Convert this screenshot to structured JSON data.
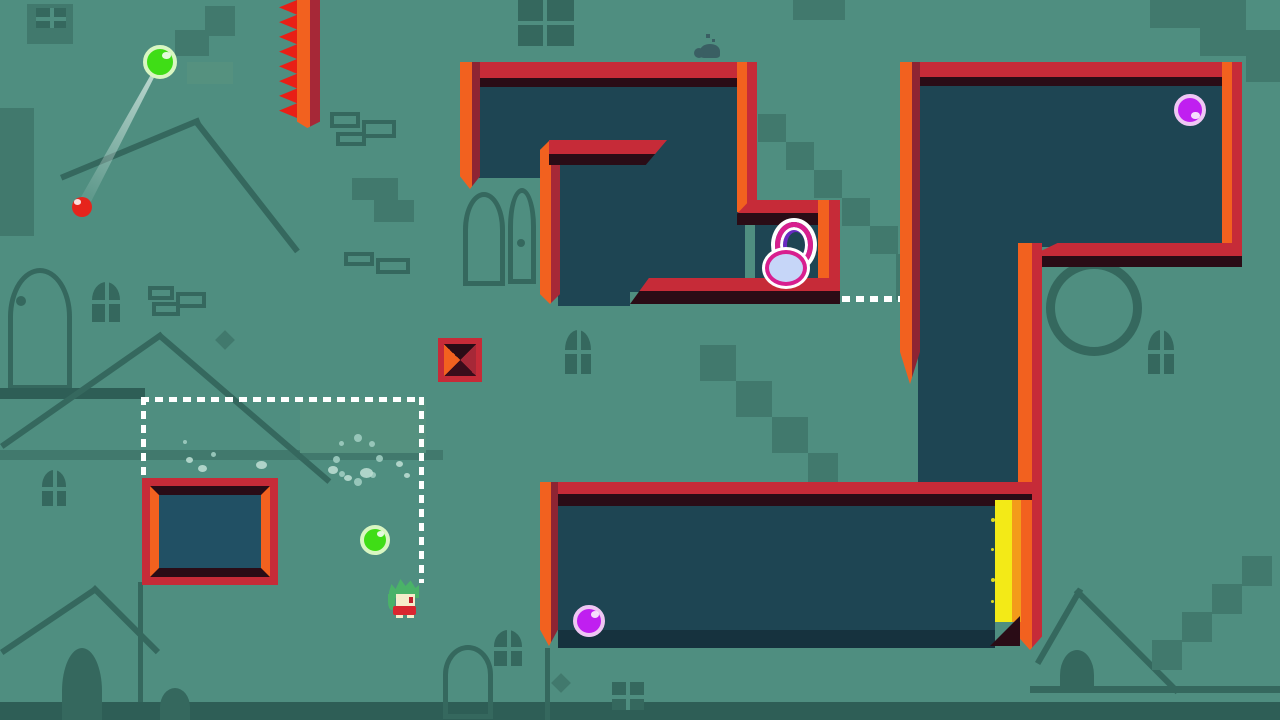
{
  "meta": {
    "view": "level-playfield",
    "width": 1280,
    "height": 720
  },
  "palette": {
    "bg": "#4f8e80",
    "shape_dark": "#41796d",
    "shape_light": "#55917f",
    "outline": "#35685e",
    "deep": "#2e5e56",
    "navy": "#1e4553",
    "navy_light": "#215064",
    "navy_floor": "#16323e",
    "crimson": "#c62b38",
    "wall_shadow": "#2a0c16",
    "orange": "#f2611f",
    "dark_red": "#8e2433",
    "inner_red": "#a62837",
    "spike_red": "#e81f16",
    "yellow": "#f3ea17",
    "yellow_orange": "#f39b1a",
    "white": "#ffffff",
    "green_fill": "#3fdd16",
    "green_rim": "#d9f6c2",
    "purple_fill": "#c01ff0",
    "purple_rim": "#efc7f4",
    "red_fill": "#e6241c",
    "ring_pink": "#d81f8f",
    "ring_purple": "#6a2ac2",
    "ring_fill": "#c6d6f8",
    "hair": "#4ab268",
    "skin": "#f6ecca",
    "outfit": "#d92630",
    "eye": "#bf1f2d",
    "critter": "#3a5f63",
    "dust": "#9fccc0",
    "dust_light": "#b9dbd0",
    "trail": "rgba(235,247,242,0.75)"
  },
  "background": {
    "shapes": [
      {
        "kind": "rect",
        "x": 27,
        "y": 4,
        "w": 46,
        "h": 40,
        "tone": "d"
      },
      {
        "kind": "win4",
        "x": 36,
        "y": 8,
        "w": 30,
        "h": 20
      },
      {
        "kind": "rect",
        "x": 205,
        "y": 6,
        "w": 30,
        "h": 30,
        "tone": "d"
      },
      {
        "kind": "rect",
        "x": 175,
        "y": 30,
        "w": 34,
        "h": 26,
        "tone": "d"
      },
      {
        "kind": "rect",
        "x": 187,
        "y": 62,
        "w": 46,
        "h": 22,
        "tone": "l"
      },
      {
        "kind": "rect",
        "x": 0,
        "y": 108,
        "w": 34,
        "h": 128,
        "tone": "d"
      },
      {
        "kind": "line",
        "x": 60,
        "y": 175,
        "len": 150,
        "th": 6,
        "rot": -22.6
      },
      {
        "kind": "line",
        "x": 197,
        "y": 118,
        "len": 167,
        "th": 6,
        "rot": 52
      },
      {
        "kind": "arch-outline",
        "x": 8,
        "y": 268,
        "w": 64,
        "h": 122
      },
      {
        "kind": "dot",
        "x": 16,
        "y": 296,
        "w": 10,
        "h": 10
      },
      {
        "kind": "win4arch",
        "x": 92,
        "y": 282,
        "w": 28,
        "h": 40
      },
      {
        "kind": "outline",
        "x": 148,
        "y": 286,
        "w": 26,
        "h": 14
      },
      {
        "kind": "outline",
        "x": 176,
        "y": 292,
        "w": 30,
        "h": 16
      },
      {
        "kind": "outline",
        "x": 152,
        "y": 302,
        "w": 28,
        "h": 14
      },
      {
        "kind": "rect",
        "x": 0,
        "y": 388,
        "w": 145,
        "h": 11,
        "tone": "g"
      },
      {
        "kind": "rect",
        "x": 0,
        "y": 450,
        "w": 443,
        "h": 10,
        "tone": "d"
      },
      {
        "kind": "line",
        "x": 0,
        "y": 444,
        "len": 196,
        "th": 6,
        "rot": -35
      },
      {
        "kind": "line",
        "x": 160,
        "y": 332,
        "len": 226,
        "th": 6,
        "rot": 40.7
      },
      {
        "kind": "rect",
        "x": 300,
        "y": 399,
        "w": 126,
        "h": 54,
        "tone": "l"
      },
      {
        "kind": "rect",
        "x": 0,
        "y": 702,
        "w": 1280,
        "h": 18,
        "tone": "g"
      },
      {
        "kind": "arch",
        "x": 160,
        "y": 688,
        "w": 30,
        "h": 32
      },
      {
        "kind": "win4",
        "x": 518,
        "y": 0,
        "w": 56,
        "h": 46
      },
      {
        "kind": "outline",
        "x": 330,
        "y": 112,
        "w": 30,
        "h": 16
      },
      {
        "kind": "outline",
        "x": 362,
        "y": 120,
        "w": 34,
        "h": 18
      },
      {
        "kind": "outline",
        "x": 336,
        "y": 132,
        "w": 30,
        "h": 14
      },
      {
        "kind": "rect",
        "x": 352,
        "y": 178,
        "w": 46,
        "h": 22,
        "tone": "d"
      },
      {
        "kind": "rect",
        "x": 374,
        "y": 200,
        "w": 40,
        "h": 22,
        "tone": "d"
      },
      {
        "kind": "outline",
        "x": 344,
        "y": 252,
        "w": 30,
        "h": 14
      },
      {
        "kind": "outline",
        "x": 376,
        "y": 258,
        "w": 34,
        "h": 16
      },
      {
        "kind": "arch-outline",
        "x": 463,
        "y": 192,
        "w": 42,
        "h": 94
      },
      {
        "kind": "arch-outline",
        "x": 508,
        "y": 188,
        "w": 28,
        "h": 96
      },
      {
        "kind": "dot",
        "x": 517,
        "y": 239,
        "w": 8,
        "h": 8
      },
      {
        "kind": "rect",
        "x": 758,
        "y": 114,
        "w": 28,
        "h": 28,
        "tone": "d"
      },
      {
        "kind": "rect",
        "x": 786,
        "y": 142,
        "w": 28,
        "h": 28,
        "tone": "d"
      },
      {
        "kind": "rect",
        "x": 814,
        "y": 170,
        "w": 28,
        "h": 28,
        "tone": "d"
      },
      {
        "kind": "rect",
        "x": 842,
        "y": 198,
        "w": 28,
        "h": 28,
        "tone": "d"
      },
      {
        "kind": "rect",
        "x": 870,
        "y": 226,
        "w": 28,
        "h": 28,
        "tone": "d"
      },
      {
        "kind": "rect",
        "x": 896,
        "y": 254,
        "w": 28,
        "h": 46,
        "tone": "d"
      },
      {
        "kind": "rect",
        "x": 793,
        "y": 0,
        "w": 52,
        "h": 20,
        "tone": "d"
      },
      {
        "kind": "rect",
        "x": 1150,
        "y": 0,
        "w": 50,
        "h": 28,
        "tone": "d"
      },
      {
        "kind": "rect",
        "x": 1200,
        "y": 0,
        "w": 46,
        "h": 56,
        "tone": "d"
      },
      {
        "kind": "rect",
        "x": 1246,
        "y": 30,
        "w": 34,
        "h": 52,
        "tone": "d"
      },
      {
        "kind": "circle-outline",
        "x": 1046,
        "y": 260,
        "w": 96,
        "h": 96
      },
      {
        "kind": "win4arch",
        "x": 1148,
        "y": 330,
        "w": 26,
        "h": 44
      },
      {
        "kind": "win4arch",
        "x": 565,
        "y": 330,
        "w": 26,
        "h": 44
      },
      {
        "kind": "rect",
        "x": 700,
        "y": 345,
        "w": 36,
        "h": 36,
        "tone": "d"
      },
      {
        "kind": "rect",
        "x": 736,
        "y": 381,
        "w": 36,
        "h": 36,
        "tone": "d"
      },
      {
        "kind": "rect",
        "x": 772,
        "y": 417,
        "w": 36,
        "h": 36,
        "tone": "d"
      },
      {
        "kind": "rect",
        "x": 808,
        "y": 453,
        "w": 30,
        "h": 30,
        "tone": "d"
      },
      {
        "kind": "line",
        "x": 0,
        "y": 650,
        "len": 114,
        "th": 6,
        "rot": -34
      },
      {
        "kind": "line",
        "x": 95,
        "y": 585,
        "len": 92,
        "th": 6,
        "rot": 45
      },
      {
        "kind": "arch",
        "x": 62,
        "y": 648,
        "w": 40,
        "h": 72
      },
      {
        "kind": "rect",
        "x": 138,
        "y": 582,
        "w": 5,
        "h": 120,
        "tone": "o"
      },
      {
        "kind": "arch-outline",
        "x": 443,
        "y": 645,
        "w": 50,
        "h": 74
      },
      {
        "kind": "win4arch",
        "x": 494,
        "y": 630,
        "w": 28,
        "h": 36
      },
      {
        "kind": "rect",
        "x": 545,
        "y": 648,
        "w": 5,
        "h": 72,
        "tone": "o"
      },
      {
        "kind": "win4",
        "x": 612,
        "y": 682,
        "w": 32,
        "h": 28
      },
      {
        "kind": "diamond",
        "x": 554,
        "y": 676,
        "w": 14,
        "h": 14
      },
      {
        "kind": "line",
        "x": 1035,
        "y": 662,
        "len": 86,
        "th": 6,
        "rot": -60
      },
      {
        "kind": "line",
        "x": 1078,
        "y": 588,
        "len": 144,
        "th": 6,
        "rot": 45
      },
      {
        "kind": "arch",
        "x": 1060,
        "y": 650,
        "w": 34,
        "h": 42
      },
      {
        "kind": "rect",
        "x": 1030,
        "y": 686,
        "w": 250,
        "h": 7,
        "tone": "o"
      },
      {
        "kind": "rect",
        "x": 1152,
        "y": 640,
        "w": 30,
        "h": 30,
        "tone": "d"
      },
      {
        "kind": "rect",
        "x": 1182,
        "y": 612,
        "w": 30,
        "h": 30,
        "tone": "d"
      },
      {
        "kind": "rect",
        "x": 1212,
        "y": 584,
        "w": 30,
        "h": 30,
        "tone": "d"
      },
      {
        "kind": "rect",
        "x": 1242,
        "y": 556,
        "w": 30,
        "h": 30,
        "tone": "d"
      },
      {
        "kind": "win4arch",
        "x": 42,
        "y": 470,
        "w": 24,
        "h": 36
      },
      {
        "kind": "diamond",
        "x": 218,
        "y": 333,
        "w": 14,
        "h": 14
      }
    ]
  },
  "pits": [
    {
      "name": "pit-a-left",
      "x": 479,
      "y": 78,
      "w": 66,
      "h": 100
    },
    {
      "name": "pit-a-main",
      "x": 545,
      "y": 78,
      "w": 200,
      "h": 214
    },
    {
      "name": "pit-a-pocket",
      "x": 755,
      "y": 215,
      "w": 80,
      "h": 77
    },
    {
      "name": "pit-a-gap",
      "x": 558,
      "y": 278,
      "w": 72,
      "h": 28
    },
    {
      "name": "pit-b-room",
      "x": 918,
      "y": 75,
      "w": 306,
      "h": 172
    },
    {
      "name": "pit-b-column",
      "x": 918,
      "y": 247,
      "w": 100,
      "h": 236
    },
    {
      "name": "pit-c-room",
      "x": 558,
      "y": 500,
      "w": 437,
      "h": 148
    },
    {
      "name": "pit-c-floor-shade",
      "x": 558,
      "y": 630,
      "w": 437,
      "h": 18,
      "shade": "floor"
    }
  ],
  "walls": [
    {
      "name": "wall-a-top",
      "x": 460,
      "y": 62,
      "w": 297,
      "h": 25,
      "axis": "h",
      "split": 16
    },
    {
      "name": "wall-a-left",
      "x": 460,
      "y": 62,
      "w": 20,
      "h": 127,
      "axis": "v",
      "c2k": "dark_red",
      "split": 12,
      "clip": "tipdown"
    },
    {
      "name": "wall-a-inner-vert",
      "x": 540,
      "y": 140,
      "w": 20,
      "h": 164,
      "axis": "v",
      "c2k": "inner_red",
      "split": 11,
      "clip": "tipboth"
    },
    {
      "name": "wall-a-inner-shelf",
      "x": 549,
      "y": 140,
      "w": 118,
      "h": 25,
      "axis": "h",
      "split": 14,
      "clip": "shelfright"
    },
    {
      "name": "wall-a-right",
      "x": 737,
      "y": 62,
      "w": 20,
      "h": 150,
      "axis": "v",
      "c2k": "crimson",
      "split": 10
    },
    {
      "name": "wall-a-pocket-top",
      "x": 737,
      "y": 200,
      "w": 101,
      "h": 25,
      "axis": "h",
      "split": 13,
      "clip": "bevelleft"
    },
    {
      "name": "wall-a-pocket-right",
      "x": 818,
      "y": 200,
      "w": 22,
      "h": 100,
      "axis": "v",
      "c2k": "crimson",
      "split": 11
    },
    {
      "name": "wall-a-bottom",
      "x": 630,
      "y": 278,
      "w": 210,
      "h": 26,
      "axis": "h",
      "split": 13,
      "clip": "taperleft"
    },
    {
      "name": "wall-b-top",
      "x": 900,
      "y": 62,
      "w": 340,
      "h": 24,
      "axis": "h",
      "split": 15
    },
    {
      "name": "wall-b-left",
      "x": 900,
      "y": 62,
      "w": 20,
      "h": 322,
      "axis": "v",
      "c2k": "dark_red",
      "split": 12,
      "clip": "tipdown"
    },
    {
      "name": "wall-b-right",
      "x": 1222,
      "y": 62,
      "w": 20,
      "h": 198,
      "axis": "v",
      "c2k": "crimson",
      "split": 10
    },
    {
      "name": "wall-b-bottom-step",
      "x": 1030,
      "y": 243,
      "w": 212,
      "h": 24,
      "axis": "h",
      "split": 13,
      "clip": "bevelleft"
    },
    {
      "name": "wall-b-column-right",
      "x": 1018,
      "y": 243,
      "w": 24,
      "h": 260,
      "axis": "v",
      "c2k": "crimson",
      "split": 14
    },
    {
      "name": "wall-c-top",
      "x": 540,
      "y": 482,
      "w": 492,
      "h": 24,
      "axis": "h",
      "split": 12
    },
    {
      "name": "wall-c-left",
      "x": 540,
      "y": 482,
      "w": 18,
      "h": 164,
      "axis": "v",
      "c2k": "dark_red",
      "split": 11,
      "clip": "tipdown"
    },
    {
      "name": "wall-c-right",
      "x": 1018,
      "y": 500,
      "w": 24,
      "h": 150,
      "axis": "v",
      "c2k": "crimson",
      "split": 14,
      "clip": "tipdown2"
    }
  ],
  "goal": {
    "name": "goal-strip",
    "x": 995,
    "y": 500,
    "w": 26,
    "h": 122,
    "split": 17,
    "wedge": {
      "x": 990,
      "y": 616,
      "w": 30,
      "h": 30
    }
  },
  "frame_box": {
    "name": "frame-box",
    "x": 142,
    "y": 478,
    "w": 136,
    "h": 107,
    "outer": 8,
    "inner": 9
  },
  "dashes": [
    {
      "name": "capture-zone-top",
      "x": 141,
      "y": 397,
      "w": 283,
      "h": 5,
      "axis": "h"
    },
    {
      "name": "capture-zone-left",
      "x": 141,
      "y": 397,
      "w": 5,
      "h": 83,
      "axis": "v"
    },
    {
      "name": "capture-zone-right",
      "x": 419,
      "y": 397,
      "w": 5,
      "h": 186,
      "axis": "v"
    },
    {
      "name": "ghost-platform",
      "x": 842,
      "y": 296,
      "w": 58,
      "h": 6,
      "axis": "h"
    }
  ],
  "trajectory": {
    "x": 160,
    "y": 62,
    "len": 165,
    "th": 12,
    "rot": 118.3
  },
  "balls": [
    {
      "name": "ball-green-aimed",
      "cx": 160,
      "cy": 62,
      "r": 17,
      "fill": "green_fill",
      "rim": "green_rim",
      "rimw": 4,
      "hi": "tr"
    },
    {
      "name": "ball-green",
      "cx": 375,
      "cy": 540,
      "r": 15,
      "fill": "green_fill",
      "rim": "green_rim",
      "rimw": 4,
      "hi": "tr"
    },
    {
      "name": "ball-red-small",
      "cx": 82,
      "cy": 207,
      "r": 10,
      "fill": "red_fill",
      "rim": "red_fill",
      "rimw": 0,
      "hi": "tl"
    },
    {
      "name": "ball-purple-top",
      "cx": 1190,
      "cy": 110,
      "r": 16,
      "fill": "purple_fill",
      "rim": "purple_rim",
      "rimw": 4,
      "hi": "br"
    },
    {
      "name": "ball-purple-bottom",
      "cx": 589,
      "cy": 621,
      "r": 16,
      "fill": "purple_fill",
      "rim": "purple_rim",
      "rimw": 4,
      "hi": "tr"
    }
  ],
  "rings_item": {
    "name": "rings-pickup",
    "x": 763,
    "y": 222,
    "w": 58,
    "h": 66
  },
  "hazard_block": {
    "name": "spike-block",
    "x": 438,
    "y": 338,
    "w": 44,
    "h": 44,
    "border": 6
  },
  "player": {
    "name": "player-character",
    "x": 388,
    "y": 578,
    "w": 32,
    "h": 40
  },
  "critter": {
    "name": "snail-critter",
    "x": 692,
    "y": 34,
    "w": 32,
    "h": 26
  },
  "spikes": {
    "bar": {
      "x": 297,
      "y": 0,
      "w": 23,
      "h": 128
    },
    "zigzag": {
      "x": 279,
      "y": 0,
      "w": 18,
      "h": 118
    }
  },
  "effects": [
    {
      "x": 376,
      "y": 455,
      "w": 7,
      "h": 7,
      "c": "dust"
    },
    {
      "x": 369,
      "y": 441,
      "w": 6,
      "h": 6,
      "c": "dust"
    },
    {
      "x": 354,
      "y": 434,
      "w": 8,
      "h": 8,
      "c": "dust"
    },
    {
      "x": 339,
      "y": 441,
      "w": 5,
      "h": 5,
      "c": "dust"
    },
    {
      "x": 333,
      "y": 456,
      "w": 7,
      "h": 7,
      "c": "dust"
    },
    {
      "x": 339,
      "y": 471,
      "w": 6,
      "h": 6,
      "c": "dust"
    },
    {
      "x": 354,
      "y": 478,
      "w": 8,
      "h": 8,
      "c": "dust"
    },
    {
      "x": 370,
      "y": 472,
      "w": 6,
      "h": 6,
      "c": "dust"
    },
    {
      "x": 186,
      "y": 457,
      "w": 7,
      "h": 6,
      "c": "dust_light"
    },
    {
      "x": 198,
      "y": 465,
      "w": 9,
      "h": 7,
      "c": "dust_light"
    },
    {
      "x": 211,
      "y": 452,
      "w": 5,
      "h": 5,
      "c": "dust"
    },
    {
      "x": 256,
      "y": 461,
      "w": 11,
      "h": 8,
      "c": "dust_light"
    },
    {
      "x": 183,
      "y": 440,
      "w": 4,
      "h": 4,
      "c": "dust"
    },
    {
      "x": 328,
      "y": 466,
      "w": 10,
      "h": 8,
      "c": "dust_light"
    },
    {
      "x": 344,
      "y": 475,
      "w": 8,
      "h": 6,
      "c": "dust_light"
    },
    {
      "x": 360,
      "y": 468,
      "w": 13,
      "h": 10,
      "c": "dust_light"
    },
    {
      "x": 396,
      "y": 461,
      "w": 7,
      "h": 6,
      "c": "dust_light"
    },
    {
      "x": 404,
      "y": 473,
      "w": 6,
      "h": 5,
      "c": "dust_light"
    },
    {
      "x": 991,
      "y": 518,
      "w": 4,
      "h": 4,
      "c": "yellow"
    },
    {
      "x": 991,
      "y": 548,
      "w": 3,
      "h": 3,
      "c": "yellow"
    },
    {
      "x": 991,
      "y": 578,
      "w": 4,
      "h": 4,
      "c": "yellow"
    },
    {
      "x": 991,
      "y": 600,
      "w": 3,
      "h": 3,
      "c": "yellow"
    }
  ]
}
